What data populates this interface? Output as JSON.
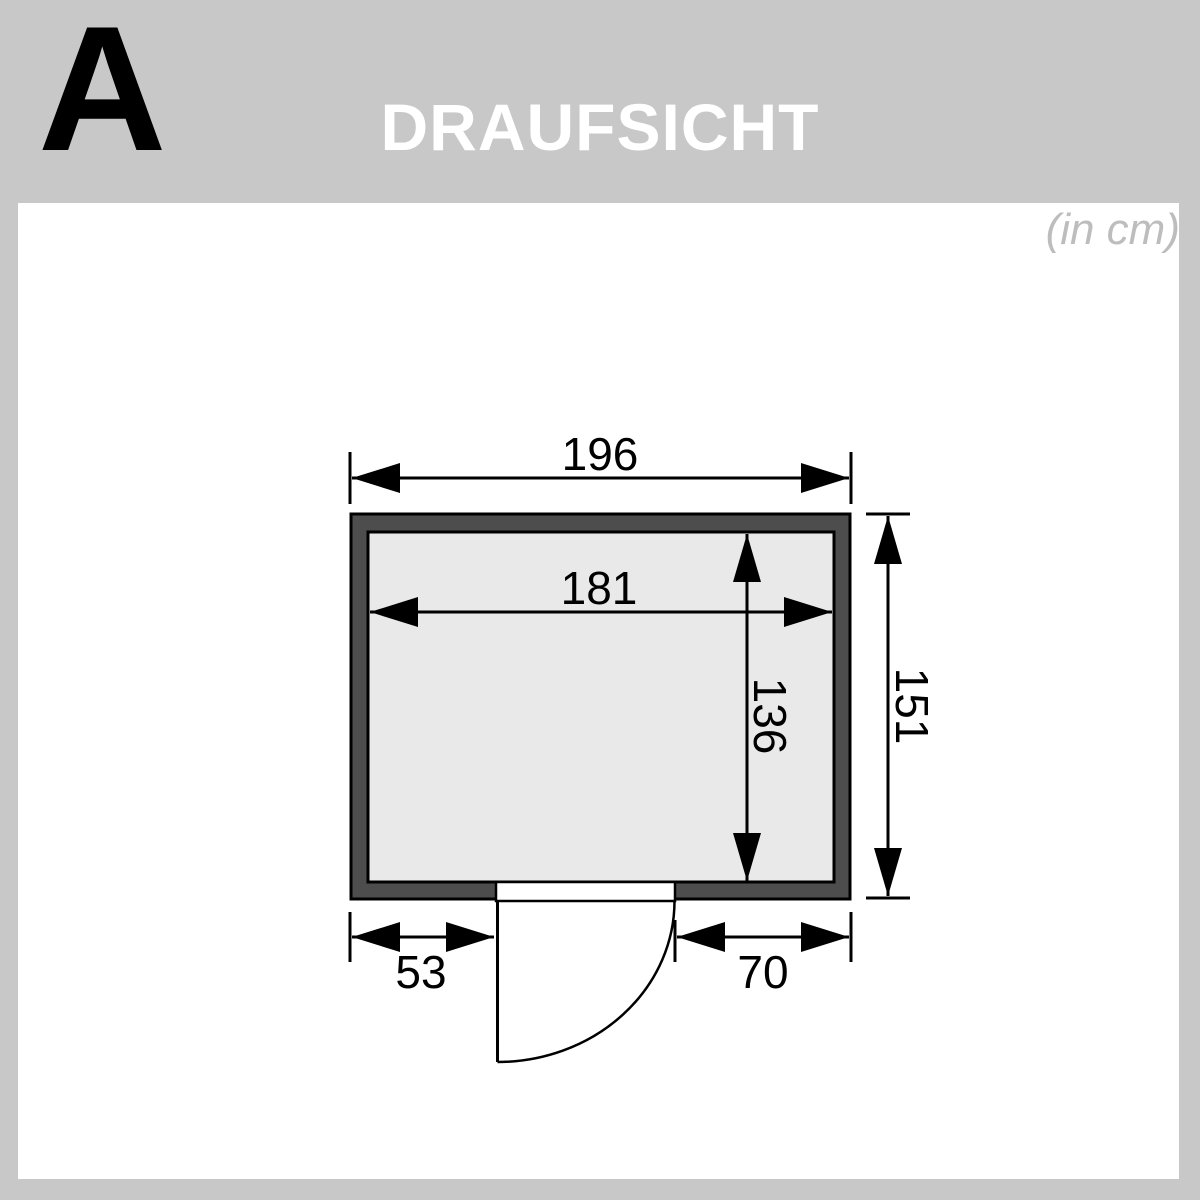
{
  "page": {
    "section_label": "A",
    "title": "DRAUFSICHT",
    "units_note": "(in cm)"
  },
  "colors": {
    "background_gray": "#c8c8c8",
    "panel_white": "#ffffff",
    "wall_fill": "#4d4d4d",
    "floor_fill": "#e9e9e9",
    "line_black": "#000000",
    "title_text": "#ffffff",
    "units_text": "#bdbdbd"
  },
  "drawing": {
    "type": "floor-plan-top-view",
    "dimensions": {
      "outer_width": "196",
      "outer_depth": "151",
      "inner_width": "181",
      "inner_depth": "136",
      "door_offset_left": "53",
      "door_offset_right": "70"
    }
  }
}
